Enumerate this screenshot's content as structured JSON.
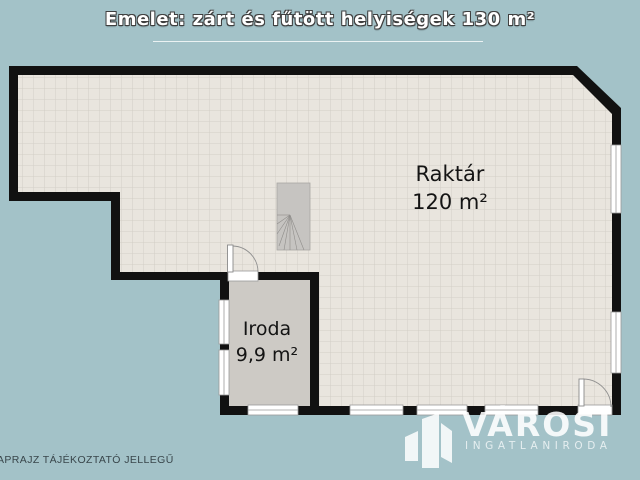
{
  "title": "Emelet: zárt és fűtött helyiségek 130 m²",
  "rooms": {
    "raktar": {
      "name": "Raktár",
      "area": "120 m²"
    },
    "iroda": {
      "name": "Iroda",
      "area": "9,9 m²"
    }
  },
  "footer": {
    "disclaimer": "APRAJZ TÁJÉKOZTATÓ JELLEGŰ"
  },
  "logo": {
    "brand": "VÁROSI",
    "subtitle": "INGATLANIRODA",
    "icon": "buildings-icon"
  },
  "colors": {
    "background": "#a3c2c8",
    "wall": "#111111",
    "tile_floor": "#e9e5de",
    "tile_grid": "#d4d0c8",
    "iroda_floor": "#cdcac5",
    "stair_fill": "#c6c4c1",
    "title_text": "#ffffff",
    "label_text": "#141414",
    "logo_text": "#ffffff"
  }
}
